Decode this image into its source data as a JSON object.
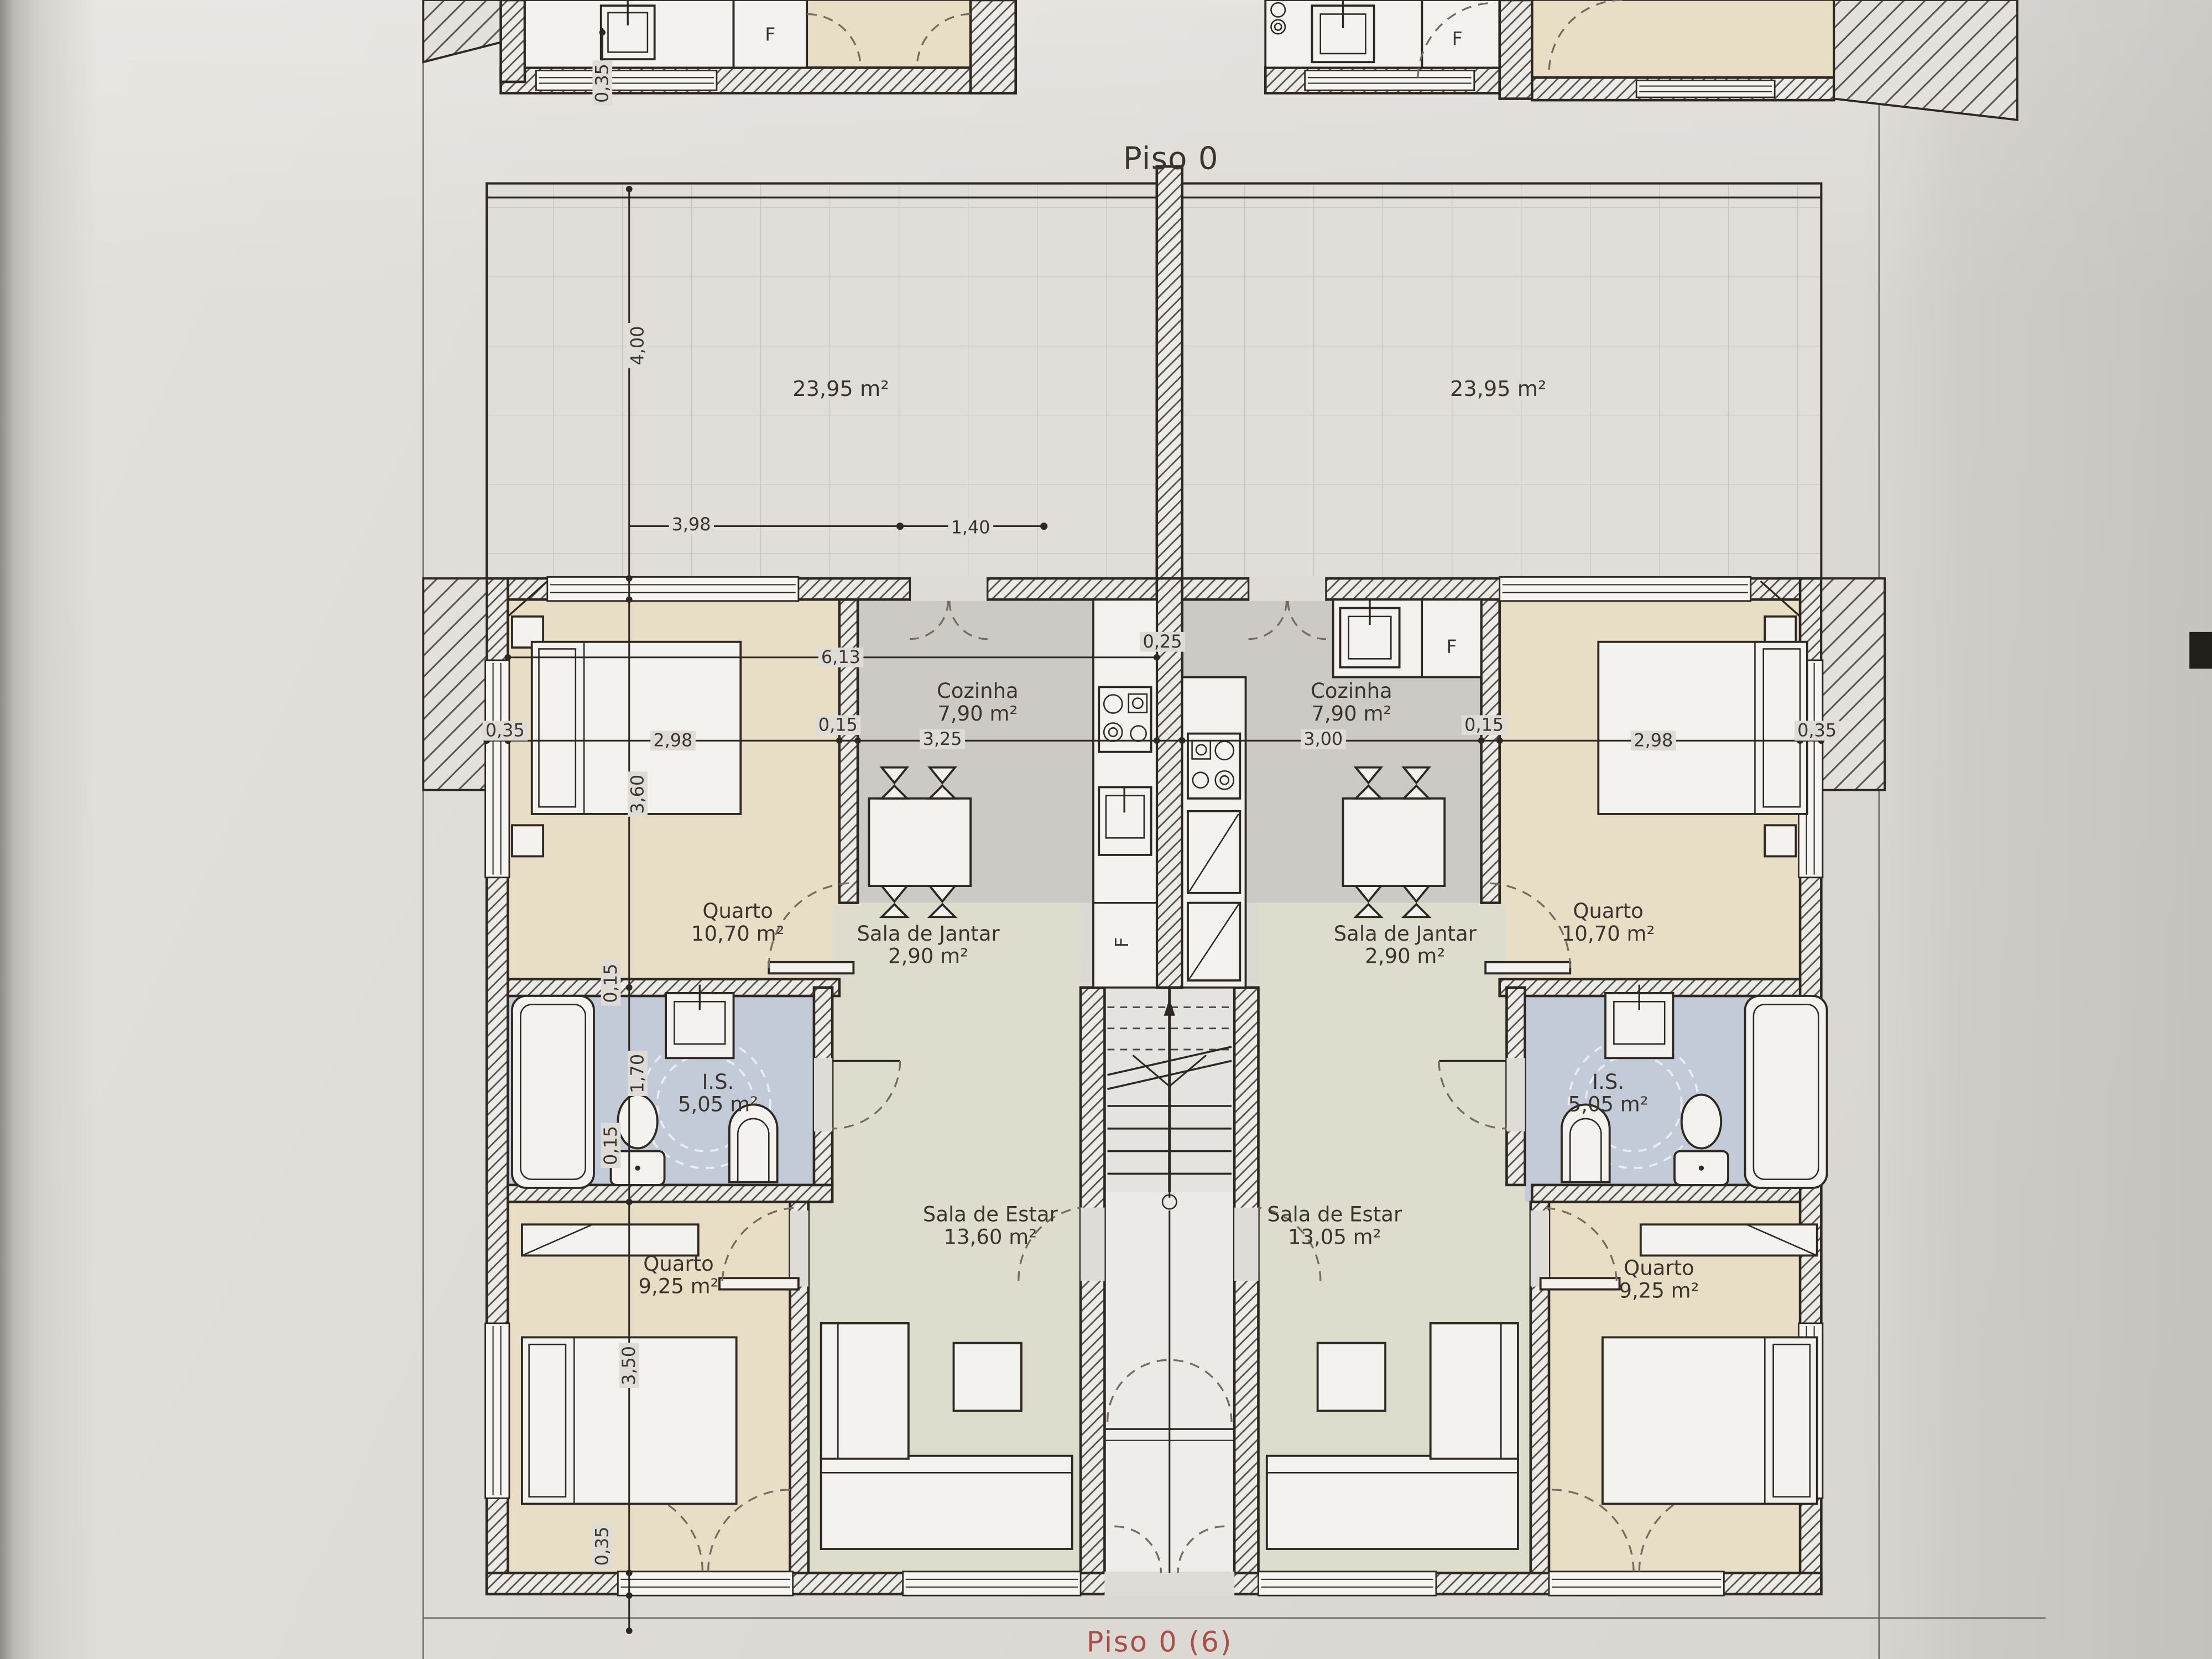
{
  "title": "Piso 0",
  "sheet_label": "Piso 0 (6)",
  "floor_plan": {
    "fridge_label": "F",
    "units": {
      "left": {
        "terrace": {
          "area": "23,95 m²"
        },
        "cozinha": {
          "name": "Cozinha",
          "area": "7,90 m²"
        },
        "quarto_top": {
          "name": "Quarto",
          "area": "10,70 m²"
        },
        "sala_jantar": {
          "name": "Sala de Jantar",
          "area": "2,90 m²"
        },
        "is": {
          "name": "I.S.",
          "area": "5,05 m²"
        },
        "sala_estar": {
          "name": "Sala de Estar",
          "area": "13,60 m²"
        },
        "quarto_bottom": {
          "name": "Quarto",
          "area": "9,25 m²"
        }
      },
      "right": {
        "terrace": {
          "area": "23,95 m²"
        },
        "cozinha": {
          "name": "Cozinha",
          "area": "7,90 m²"
        },
        "quarto_top": {
          "name": "Quarto",
          "area": "10,70 m²"
        },
        "sala_jantar": {
          "name": "Sala de Jantar",
          "area": "2,90 m²"
        },
        "is": {
          "name": "I.S.",
          "area": "5,05 m²"
        },
        "sala_estar": {
          "name": "Sala de Estar",
          "area": "13,05 m²"
        },
        "quarto_bottom": {
          "name": "Quarto",
          "area": "9,25 m²"
        }
      }
    },
    "dimensions": {
      "terrace_height": "4,00",
      "terrace_split_a": "3,98",
      "terrace_split_b": "1,40",
      "unit_width": "6,13",
      "party_wall": "0,25",
      "exterior_wall": "0,35",
      "bedroom_width": "2,98",
      "interior_wall": "0,15",
      "kitchen_width_left": "3,25",
      "kitchen_width_right": "3,00",
      "bedroom_depth": "3,60",
      "bathroom_depth": "1,70",
      "bedroom2_depth": "3,50",
      "window_wall": "0,35"
    }
  },
  "colors": {
    "paper": "#dfdcd7",
    "line": "#2f2822",
    "beige": "#e8dec6",
    "gray": "#cdcac5",
    "sage": "#deddcd",
    "blue": "#c3cbd9",
    "red": "#a03832"
  }
}
